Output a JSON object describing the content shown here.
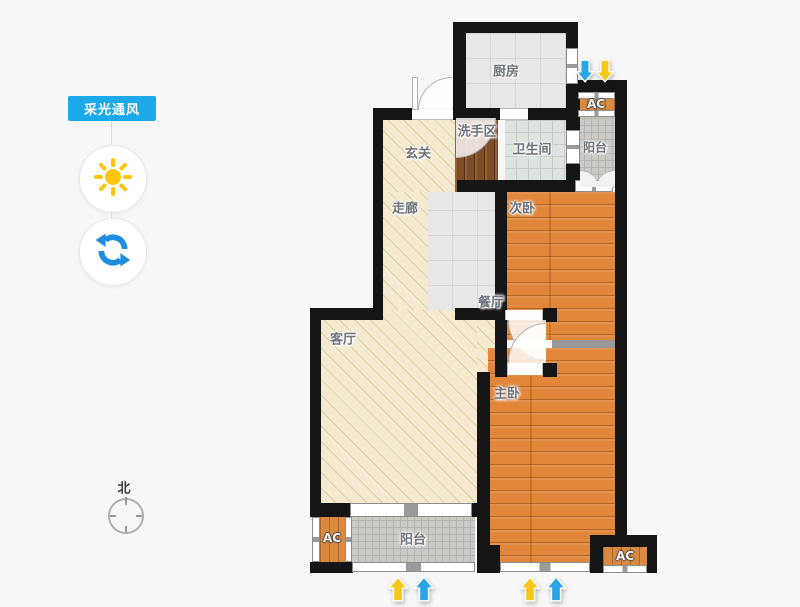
{
  "sidebar": {
    "mode_button_label": "采光通风",
    "tools": {
      "sun_tool": "sun-icon",
      "rotate_tool": "refresh-icon"
    },
    "compass": {
      "north_label": "北"
    }
  },
  "plan": {
    "rooms": {
      "kitchen": "厨房",
      "wash_area": "洗手区",
      "bathroom": "卫生间",
      "balcony_top": "阳台",
      "entry": "玄关",
      "corridor": "走廊",
      "bedroom_second": "次卧",
      "dining": "餐厅",
      "living": "客厅",
      "bedroom_master": "主卧",
      "balcony_bottom": "阳台"
    },
    "ac_labels": {
      "top_right": "AC",
      "bottom_left": "AC",
      "bottom_right": "AC"
    }
  },
  "colors": {
    "accent_blue": "#1ca9e9",
    "sun_yellow": "#ffc60a",
    "wind_arrow_blue": "#2aa4e6",
    "light_arrow_yellow": "#f5c71a",
    "wall_black": "#151515",
    "bedroom_wood": "#e0873c",
    "hall_beige": "#f3eacf"
  }
}
